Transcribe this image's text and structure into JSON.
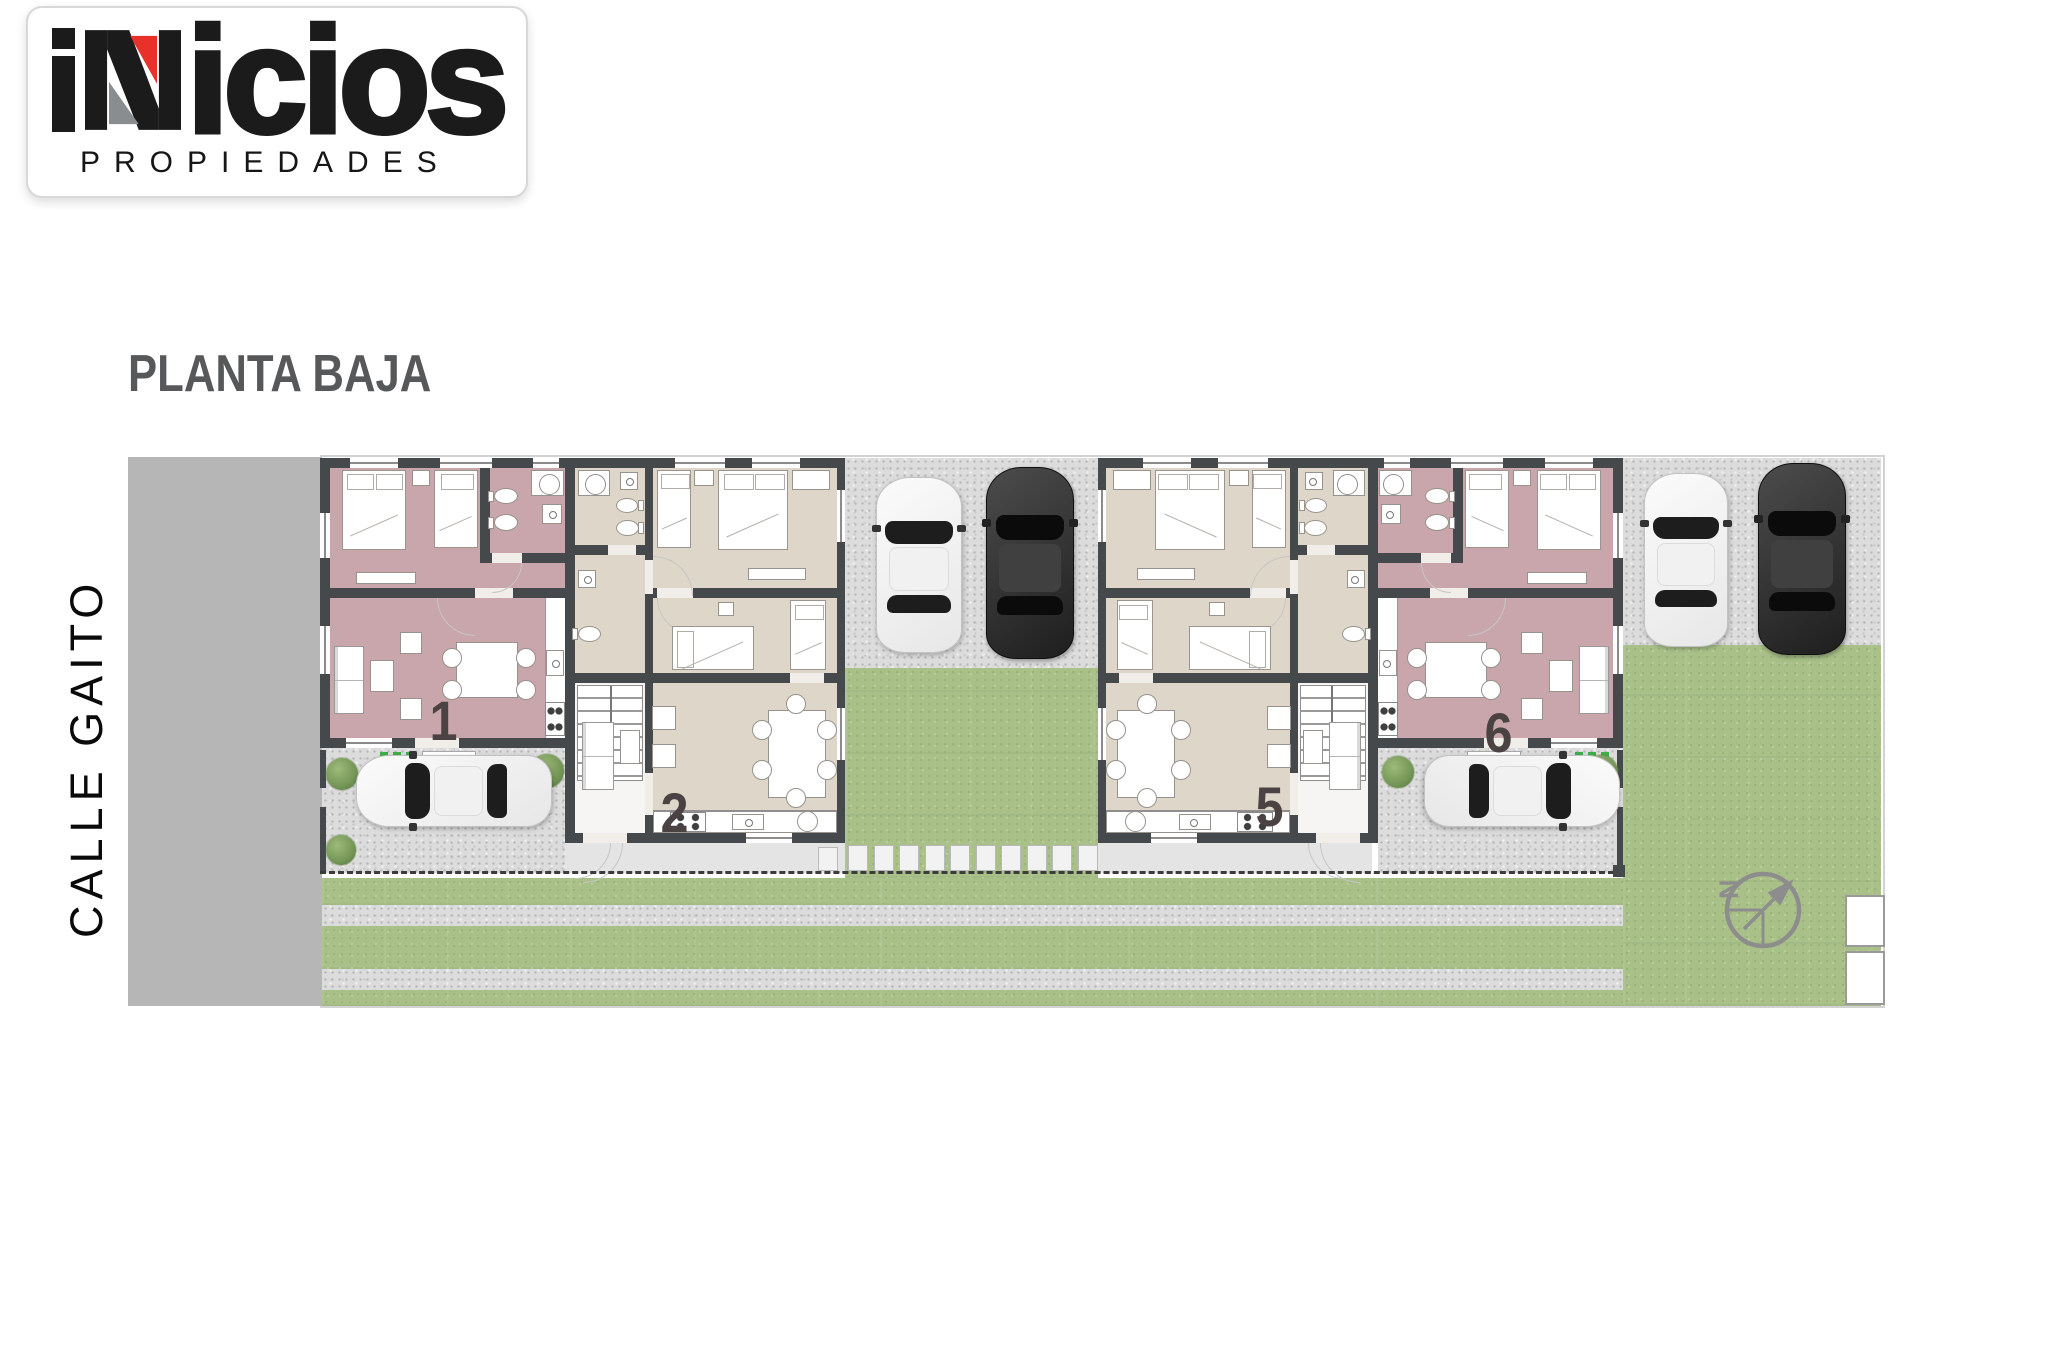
{
  "logo": {
    "brand": "inicios",
    "brand_tail": "icios",
    "tagline": "PROPIEDADES",
    "accent_red": "#e8312a",
    "accent_gray": "#8a8d90"
  },
  "heading": "PLANTA BAJA",
  "street": "CALLE GAITO",
  "compass": {
    "label": "N"
  },
  "units": [
    {
      "id": "1",
      "color": "#c9a6ab"
    },
    {
      "id": "2",
      "color": "#ded6c8"
    },
    {
      "id": "5",
      "color": "#ded6c8"
    },
    {
      "id": "6",
      "color": "#c9a6ab"
    }
  ],
  "palette": {
    "wall": "#46494b",
    "lawn_green": "#a9c189",
    "gravel_gray": "#dcdcdc",
    "street_gray": "#b6b6b6",
    "sidewalk_gray": "#e4e4e4",
    "heading_gray": "#57585a",
    "unit_number": "#4b4243"
  }
}
